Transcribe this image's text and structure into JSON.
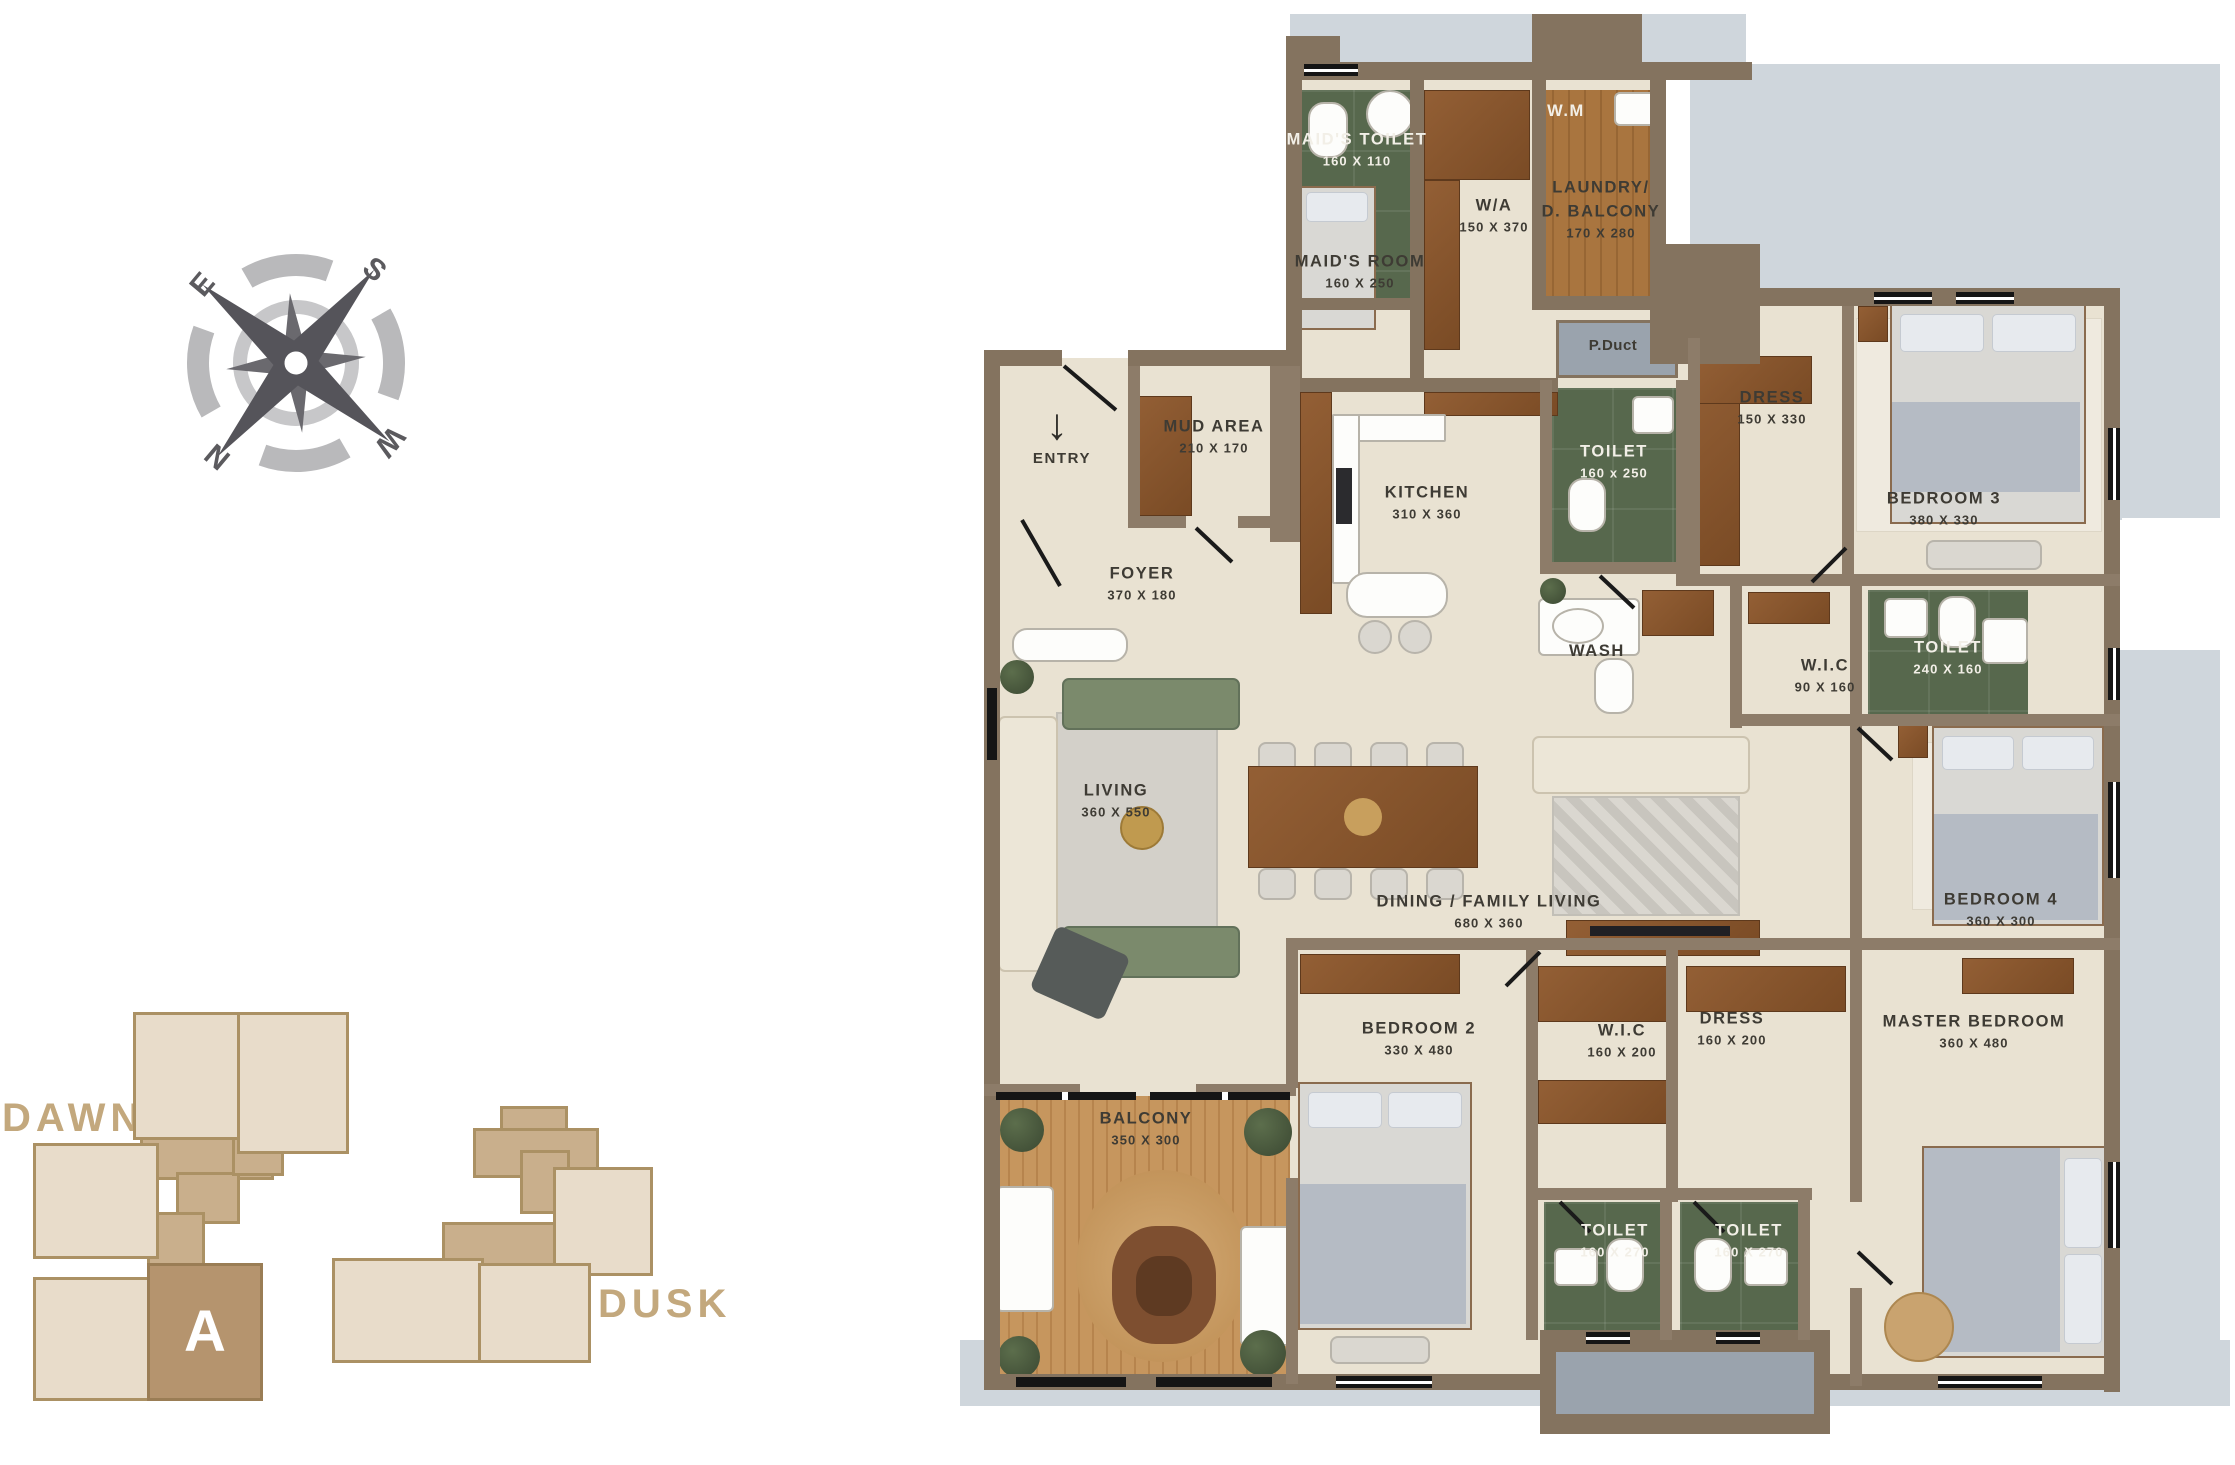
{
  "colors": {
    "wall": "#84735f",
    "wall_inner": "#8d7c69",
    "floor": "#e9e2d2",
    "tile_green": "#57684d",
    "wood_laundry": "#a9753f",
    "wood_cabinet": "#8a5a33",
    "wood_balcony": "#c6965e",
    "slab": "#cfd6dc",
    "duct_gray": "#9aa3ad",
    "keyplan_light": "#e8dcca",
    "keyplan_connector": "#c9af8c",
    "keyplan_unit": "#b5946e",
    "keyplan_text": "#c3a87d",
    "label_dark": "#3e3b34",
    "label_light": "#f2efe7"
  },
  "compass": {
    "n": "N",
    "s": "S",
    "e": "E",
    "w": "W"
  },
  "entry": {
    "label": "ENTRY",
    "arrow": "↓"
  },
  "rooms": {
    "maids_toilet": {
      "name": "MAID'S TOILET",
      "dims": "160 X 110"
    },
    "maids_room": {
      "name": "MAID'S ROOM",
      "dims": "160 X 250"
    },
    "wa": {
      "name": "W/A",
      "dims": "150 X 370"
    },
    "wm": {
      "name": "W.M"
    },
    "laundry": {
      "name_line1": "LAUNDRY/",
      "name_line2": "D. BALCONY",
      "dims": "170 X 280"
    },
    "p_duct": {
      "name": "P.Duct"
    },
    "mud_area": {
      "name": "MUD AREA",
      "dims": "210 X 170"
    },
    "kitchen": {
      "name": "KITCHEN",
      "dims": "310 X 360"
    },
    "foyer": {
      "name": "FOYER",
      "dims": "370 X 180"
    },
    "toilet_common": {
      "name": "TOILET",
      "dims": "160 x 250"
    },
    "dress_b3": {
      "name": "DRESS",
      "dims": "150 X 330"
    },
    "bedroom3": {
      "name": "BEDROOM 3",
      "dims": "380 X 330"
    },
    "wash": {
      "name": "WASH"
    },
    "wic_b4": {
      "name": "W.I.C",
      "dims": "90 X 160"
    },
    "toilet_b4": {
      "name": "TOILET",
      "dims": "240 X 160"
    },
    "living": {
      "name": "LIVING",
      "dims": "360 X 550"
    },
    "dining": {
      "name": "DINING / FAMILY LIVING",
      "dims": "680 X 360"
    },
    "bedroom4": {
      "name": "BEDROOM 4",
      "dims": "360 X 300"
    },
    "bedroom2": {
      "name": "BEDROOM 2",
      "dims": "330 X 480"
    },
    "wic_master": {
      "name": "W.I.C",
      "dims": "160 X 200"
    },
    "dress_master": {
      "name": "DRESS",
      "dims": "160 X 200"
    },
    "master_bedroom": {
      "name": "MASTER BEDROOM",
      "dims": "360 X 480"
    },
    "balcony": {
      "name": "BALCONY",
      "dims": "350 X 300"
    },
    "toilet_b2": {
      "name": "TOILET",
      "dims": "160 X 270"
    },
    "toilet_master": {
      "name": "TOILET",
      "dims": "160 X 270"
    }
  },
  "keyplan": {
    "dawn_label": "DAWN",
    "dusk_label": "DUSK",
    "unit_label": "A"
  }
}
